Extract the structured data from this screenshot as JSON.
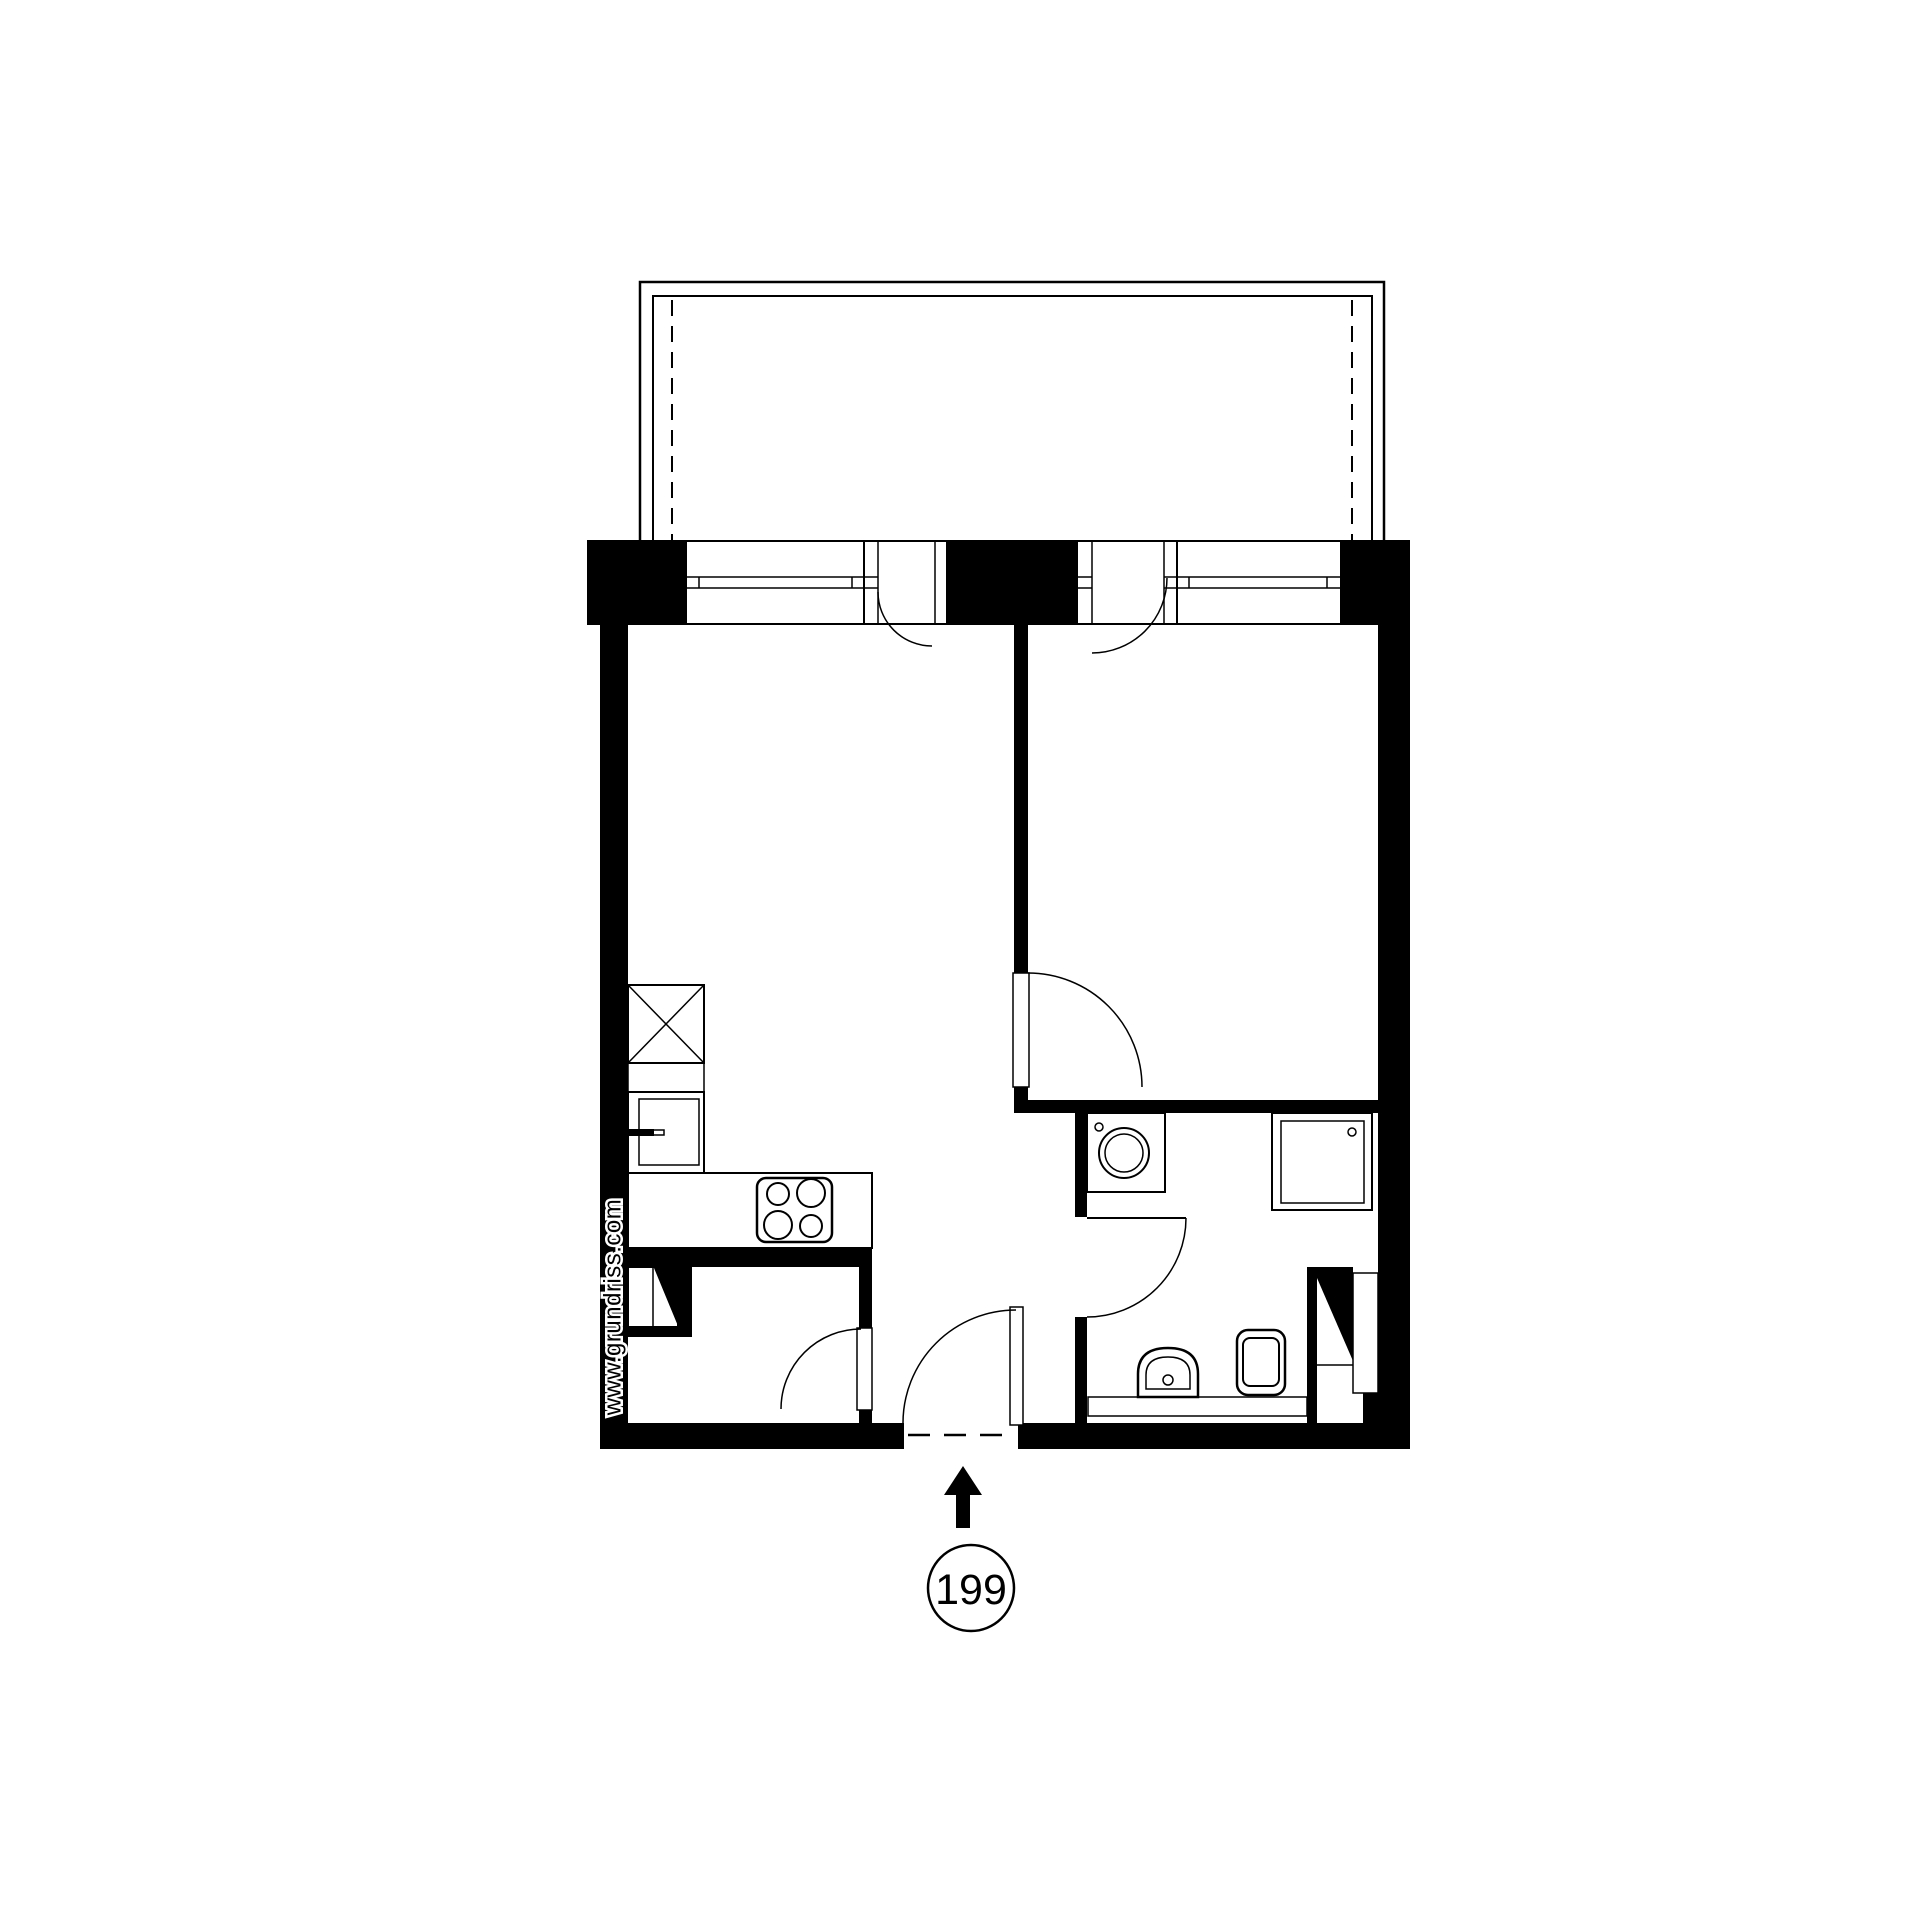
{
  "meta": {
    "background": "#ffffff",
    "ink": "#000000"
  },
  "watermark": {
    "text": "www.grundriss.com"
  },
  "entrance": {
    "unit_number": "199"
  }
}
